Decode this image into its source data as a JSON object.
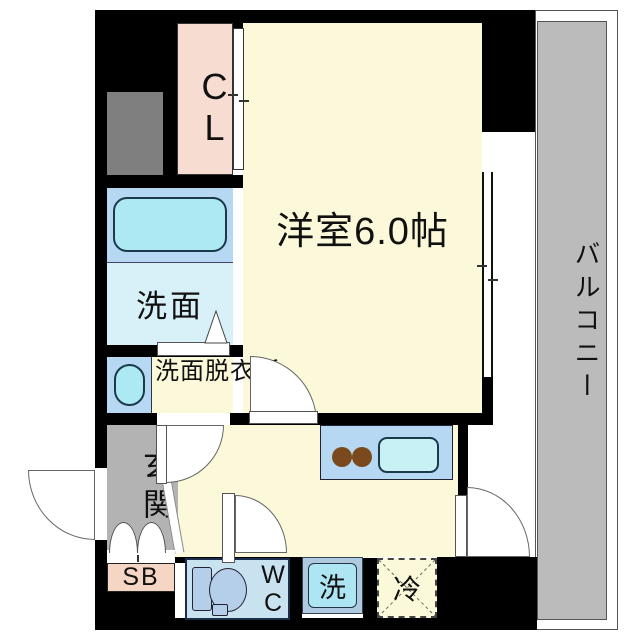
{
  "plan": {
    "type": "floorplan",
    "description": "Japanese studio apartment floor plan"
  },
  "palette": {
    "wall_black": "#000000",
    "room_cream": "#FBF9DA",
    "closet_pink": "#F6DCD1",
    "shoebox_pink": "#F5D5C4",
    "entrance_gray": "#B3B3B3",
    "balcony_gray": "#BBBBBB",
    "shaft_gray": "#7F7F7F",
    "water_blue": "#B7D8F2",
    "fixture_cyan": "#ACE9F3",
    "washroom_blue": "#D8F0F8",
    "wc_blue": "#C9E2EF",
    "toilet_blue": "#B5CEE9",
    "washer_frame_blue": "#AFC9DE",
    "washer_inner_cyan": "#ADE6F2",
    "kitchen_sink_cyan": "#C8F1F6",
    "burner_brown": "#7A4A1E",
    "door_white": "#FFFFFF"
  },
  "rooms": {
    "main_room": {
      "label": "洋室6.0帖"
    },
    "closet": {
      "label": "CL"
    },
    "balcony": {
      "label": "バルコニー"
    },
    "washroom": {
      "label": "洗面"
    },
    "dressing_room": {
      "label": "洗面脱衣所"
    },
    "entrance": {
      "label": "玄関"
    },
    "shoebox": {
      "label": "SB"
    },
    "toilet_room": {
      "label": "WC"
    },
    "washer": {
      "label": "洗"
    },
    "refrigerator": {
      "label": "冷"
    }
  }
}
